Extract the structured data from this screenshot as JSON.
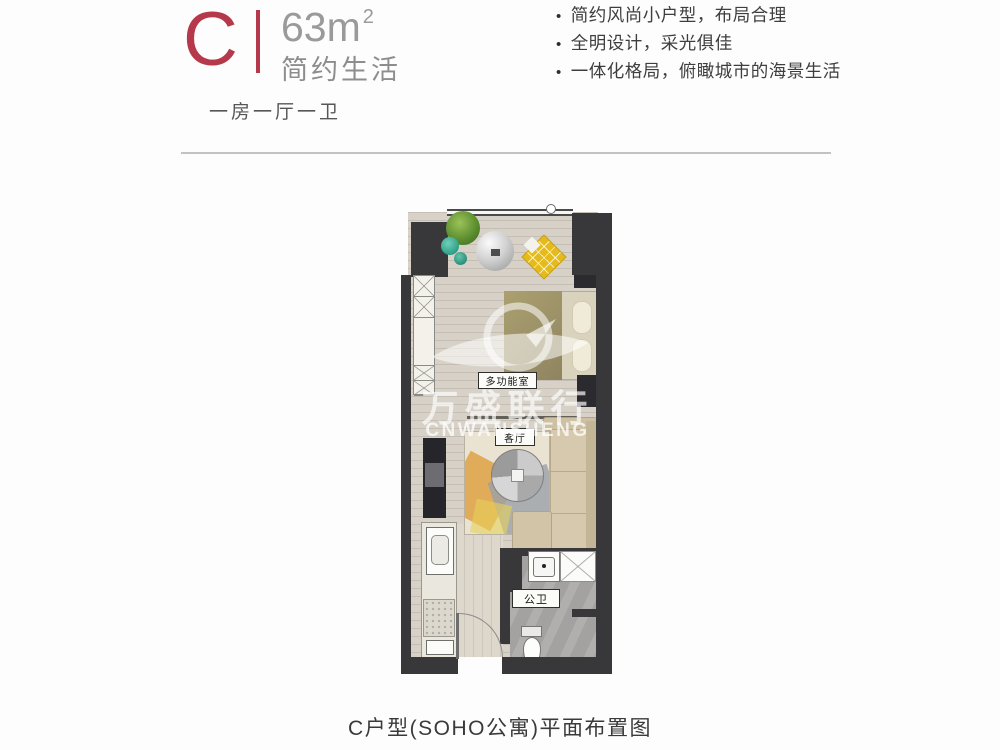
{
  "header": {
    "unit_letter": "C",
    "area_value": "63m",
    "area_superscript": "2",
    "tagline": "简约生活",
    "layout_spec": "一房一厅一卫",
    "accent_color": "#b5394a",
    "features": [
      "简约风尚小户型，布局合理",
      "全明设计，采光俱佳",
      "一体化格局，俯瞰城市的海景生活"
    ]
  },
  "plan": {
    "labels": {
      "multifunction_room": "多功能室",
      "living_room": "客厅",
      "bathroom": "公卫"
    },
    "watermark": {
      "logo_icon": "swoosh-bird-logo",
      "cn": "万盛联行",
      "en": "CNWANSHENG"
    },
    "colors": {
      "wall": "#38383b",
      "floor": "#d7d1c7",
      "bath_floor": "#a3a2a0",
      "sofa": "#d6c9ad",
      "chair_yellow": "#e4bb1b"
    }
  },
  "caption": "C户型(SOHO公寓)平面布置图"
}
